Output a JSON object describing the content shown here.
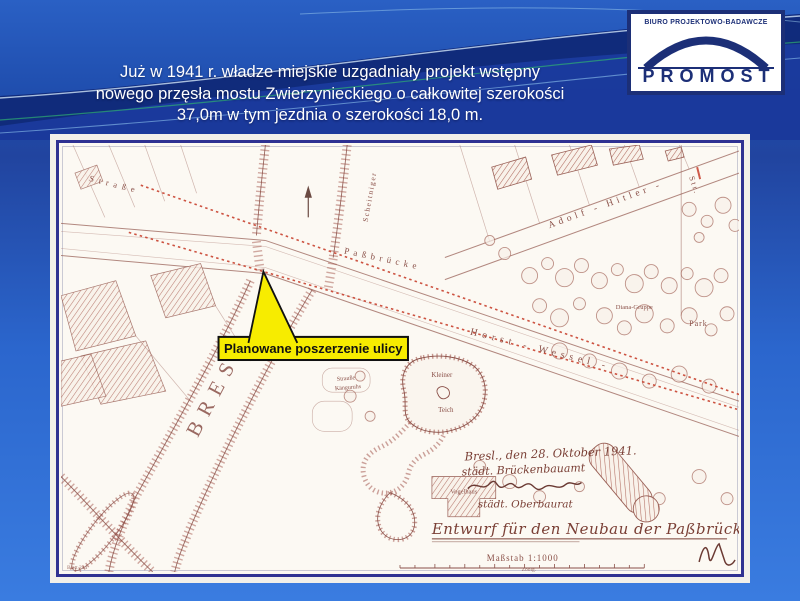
{
  "slide": {
    "title_lines": [
      "Już w 1941 r. władze miejskie uzgadniały projekt wstępny",
      "nowego przęsła mostu Zwierzynieckiego o całkowitej szerokości",
      "37,0m w tym jezdnia o szerokości 18,0 m."
    ],
    "colors": {
      "background_top": "#2a60c4",
      "background_bottom": "#3a7ce0",
      "swoosh_dark": "#132f7e",
      "title_text": "#ffffff"
    }
  },
  "logo": {
    "line1": "BIURO PROJEKTOWO-BADAWCZE",
    "name": "PROMOST",
    "navy": "#1c2f77"
  },
  "map": {
    "callout": {
      "label": "Planowane poszerzenie ulicy",
      "fill_color": "#f7ec00",
      "border_color": "#111111"
    },
    "labels": {
      "city": "BRESL",
      "street_top": "Straße",
      "bridge_street": "Paßbrücke",
      "adolf_hitler": "Adolf - Hitler -",
      "str_abbrev": "Str.",
      "horst_wessel": "Horst - Wessel -",
      "scheitniger": "Scheitniger",
      "park": "Park",
      "diana": "Diana-Gruppe",
      "pond_line1": "Kleiner",
      "pond_line2": "Teich",
      "vogelhaus": "Vogelhaus",
      "zoo_pen1": "Strauße",
      "zoo_pen2": "Känguruhs",
      "blatt": "Blatt 244",
      "zool": "Zoolg."
    },
    "annotations": {
      "date_line": "Bresl., den 28. Oktober 1941.",
      "office_line": "städt. Brückenbauamt",
      "rank_line": "städt. Oberbaurat",
      "title_line": "Entwurf für den Neubau der Paßbrücke.",
      "scale_label": "Maßstab 1:1000"
    },
    "ink_color": "#8a5048",
    "planned_line_color": "#c8402e",
    "frame_color": "#2e3192"
  }
}
